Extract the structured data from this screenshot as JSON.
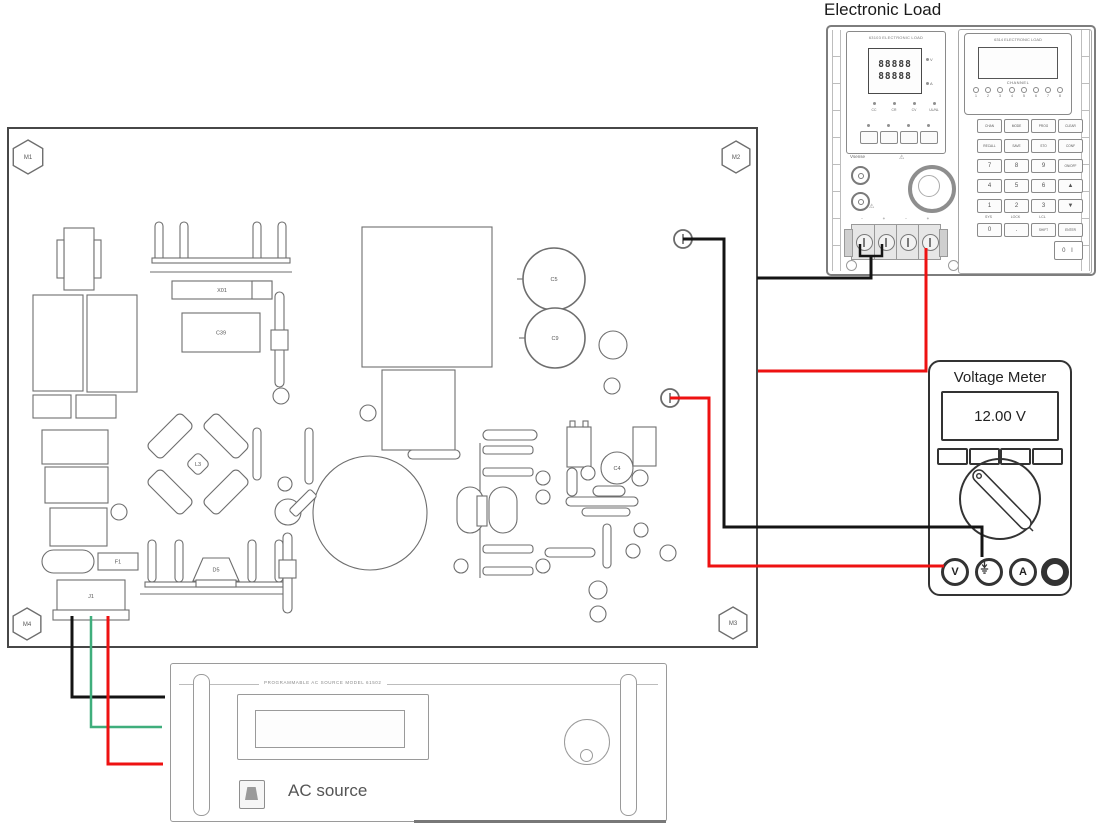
{
  "electronic_load": {
    "title": "Electronic Load",
    "left_module": {
      "model_header": "63103 ELECTRONIC LOAD",
      "display_line1": "88888",
      "display_line2": "88888",
      "unit_v": "V",
      "unit_a": "A",
      "mode_labels": [
        "CC",
        "CR",
        "CV",
        "UL/NL"
      ],
      "buttons": [
        "",
        "",
        "",
        ""
      ],
      "vsense_label": "Vsense",
      "warning_icon": "warning-triangle",
      "terminal_marks": [
        "-",
        "+",
        "-",
        "+"
      ]
    },
    "right_module": {
      "model_header": "6314 ELECTRONIC LOAD",
      "channel_label": "CHANNEL",
      "channel_numbers": [
        "1",
        "2",
        "3",
        "4",
        "5",
        "6",
        "7",
        "8"
      ],
      "keys": [
        [
          "CHAN",
          "MODE",
          "PROG",
          "CLEAR"
        ],
        [
          "RECALL",
          "SAVE",
          "STO",
          "CONF"
        ],
        [
          "7",
          "8",
          "9",
          "ON/OFF"
        ],
        [
          "4",
          "5",
          "6",
          "▲"
        ],
        [
          "1",
          "2",
          "3",
          "▼"
        ],
        [
          "0",
          ".",
          "SHIFT",
          "ENTER"
        ]
      ],
      "key_sublabels": [
        "SYS",
        "LOCK",
        "LCL"
      ],
      "power_label": "POWER",
      "power_switch_label": "0 I"
    }
  },
  "voltage_meter": {
    "title": "Voltage Meter",
    "reading": "12.00 V",
    "terminals": [
      {
        "label": "V"
      },
      {
        "icon": "ground"
      },
      {
        "label": "A"
      },
      {
        "label": ""
      }
    ]
  },
  "ac_source": {
    "panel_header": "PROGRAMMABLE AC SOURCE MODEL 61502",
    "label": "AC source",
    "keys": [
      [
        "",
        "",
        "1",
        "2",
        "3"
      ],
      [
        "",
        "",
        "4",
        "5",
        "6"
      ],
      [
        "",
        "",
        "7",
        "8",
        "9"
      ],
      [
        "",
        "",
        ".",
        "0",
        ""
      ]
    ]
  },
  "pcb": {
    "mount_labels": [
      "M1",
      "M2",
      "M3",
      "M4"
    ],
    "components": [
      {
        "t": "hex",
        "cx": 28,
        "cy": 157,
        "r": 17,
        "label": "M1"
      },
      {
        "t": "hex",
        "cx": 736,
        "cy": 157,
        "r": 16,
        "label": "M2"
      },
      {
        "t": "hex",
        "cx": 733,
        "cy": 623,
        "r": 16,
        "label": "M3"
      },
      {
        "t": "hex",
        "cx": 27,
        "cy": 624,
        "r": 16,
        "label": "M4"
      },
      {
        "t": "rect",
        "x": 64,
        "y": 228,
        "w": 30,
        "h": 62
      },
      {
        "t": "rect",
        "x": 57,
        "y": 240,
        "w": 7,
        "h": 38
      },
      {
        "t": "rect",
        "x": 94,
        "y": 240,
        "w": 7,
        "h": 38
      },
      {
        "t": "rect",
        "x": 33,
        "y": 295,
        "w": 50,
        "h": 96
      },
      {
        "t": "rect",
        "x": 87,
        "y": 295,
        "w": 50,
        "h": 97
      },
      {
        "t": "rect",
        "x": 33,
        "y": 395,
        "w": 38,
        "h": 23
      },
      {
        "t": "rect",
        "x": 76,
        "y": 395,
        "w": 40,
        "h": 23
      },
      {
        "t": "rect",
        "x": 42,
        "y": 430,
        "w": 66,
        "h": 34
      },
      {
        "t": "rect",
        "x": 45,
        "y": 467,
        "w": 63,
        "h": 36
      },
      {
        "t": "rect",
        "x": 50,
        "y": 508,
        "w": 57,
        "h": 38
      },
      {
        "t": "pill",
        "x": 42,
        "y": 550,
        "w": 52,
        "h": 23
      },
      {
        "t": "rect",
        "x": 98,
        "y": 553,
        "w": 40,
        "h": 17,
        "label": "F1"
      },
      {
        "t": "vpill",
        "x": 155,
        "y": 222,
        "w": 8,
        "h": 40
      },
      {
        "t": "vpill",
        "x": 180,
        "y": 222,
        "w": 8,
        "h": 40
      },
      {
        "t": "vpill",
        "x": 253,
        "y": 222,
        "w": 8,
        "h": 40
      },
      {
        "t": "vpill",
        "x": 278,
        "y": 222,
        "w": 8,
        "h": 40
      },
      {
        "t": "rect",
        "x": 152,
        "y": 258,
        "w": 138,
        "h": 5
      },
      {
        "t": "line",
        "x1": 150,
        "y1": 272,
        "x2": 292,
        "y2": 272
      },
      {
        "t": "rect",
        "x": 172,
        "y": 281,
        "w": 100,
        "h": 18,
        "label": "X01"
      },
      {
        "t": "rect",
        "x": 252,
        "y": 281,
        "w": 20,
        "h": 18
      },
      {
        "t": "rect",
        "x": 182,
        "y": 313,
        "w": 78,
        "h": 39,
        "label": "C39"
      },
      {
        "t": "vpill",
        "x": 275,
        "y": 292,
        "w": 9,
        "h": 95
      },
      {
        "t": "rect",
        "x": 271,
        "y": 330,
        "w": 17,
        "h": 20
      },
      {
        "t": "circle",
        "cx": 281,
        "cy": 396,
        "r": 8
      },
      {
        "t": "rect",
        "x": 362,
        "y": 227,
        "w": 130,
        "h": 140
      },
      {
        "t": "rect",
        "x": 382,
        "y": 370,
        "w": 73,
        "h": 80
      },
      {
        "t": "circle",
        "cx": 368,
        "cy": 413,
        "r": 8
      },
      {
        "t": "pill",
        "x": 408,
        "y": 450,
        "w": 52,
        "h": 9
      },
      {
        "t": "diag",
        "cx": 170,
        "cy": 436,
        "w": 48,
        "h": 20,
        "rot": -45
      },
      {
        "t": "diag",
        "cx": 226,
        "cy": 436,
        "w": 48,
        "h": 20,
        "rot": 45
      },
      {
        "t": "diag",
        "cx": 170,
        "cy": 492,
        "w": 48,
        "h": 20,
        "rot": 45
      },
      {
        "t": "diag",
        "cx": 226,
        "cy": 492,
        "w": 48,
        "h": 20,
        "rot": -45
      },
      {
        "t": "diag",
        "cx": 198,
        "cy": 464,
        "w": 17,
        "h": 17,
        "rot": 45,
        "label": "L3"
      },
      {
        "t": "circle",
        "cx": 370,
        "cy": 513,
        "r": 57
      },
      {
        "t": "circle",
        "cx": 288,
        "cy": 512,
        "r": 13
      },
      {
        "t": "circle",
        "cx": 285,
        "cy": 484,
        "r": 7
      },
      {
        "t": "diag",
        "cx": 303,
        "cy": 503,
        "w": 30,
        "h": 10,
        "rot": -45
      },
      {
        "t": "vpill",
        "x": 148,
        "y": 540,
        "w": 8,
        "h": 42
      },
      {
        "t": "vpill",
        "x": 175,
        "y": 540,
        "w": 8,
        "h": 42
      },
      {
        "t": "vpill",
        "x": 248,
        "y": 540,
        "w": 8,
        "h": 42
      },
      {
        "t": "vpill",
        "x": 275,
        "y": 540,
        "w": 8,
        "h": 42
      },
      {
        "t": "rect",
        "x": 145,
        "y": 582,
        "w": 138,
        "h": 5
      },
      {
        "t": "line",
        "x1": 140,
        "y1": 594,
        "x2": 287,
        "y2": 594
      },
      {
        "t": "trap",
        "x": 193,
        "y": 558,
        "w": 46,
        "h": 23,
        "label": "D5"
      },
      {
        "t": "rect",
        "x": 196,
        "y": 580,
        "w": 40,
        "h": 7
      },
      {
        "t": "circle",
        "cx": 119,
        "cy": 512,
        "r": 8
      },
      {
        "t": "vpill",
        "x": 253,
        "y": 428,
        "w": 8,
        "h": 52
      },
      {
        "t": "vpill",
        "x": 305,
        "y": 428,
        "w": 8,
        "h": 56
      },
      {
        "t": "vpill",
        "x": 283,
        "y": 533,
        "w": 9,
        "h": 80
      },
      {
        "t": "rect",
        "x": 279,
        "y": 560,
        "w": 17,
        "h": 18
      },
      {
        "t": "rect",
        "x": 57,
        "y": 580,
        "w": 68,
        "h": 32,
        "label": "J1"
      },
      {
        "t": "rect",
        "x": 53,
        "y": 610,
        "w": 76,
        "h": 10
      },
      {
        "t": "circle",
        "cx": 554,
        "cy": 279,
        "r": 31,
        "label": "C5",
        "sw": 1.6
      },
      {
        "t": "circle",
        "cx": 555,
        "cy": 338,
        "r": 30,
        "label": "C9",
        "sw": 1.6
      },
      {
        "t": "line",
        "x1": 517,
        "y1": 279,
        "x2": 523,
        "y2": 279
      },
      {
        "t": "line",
        "x1": 519,
        "y1": 338,
        "x2": 525,
        "y2": 338
      },
      {
        "t": "circle",
        "cx": 613,
        "cy": 345,
        "r": 14
      },
      {
        "t": "circle",
        "cx": 612,
        "cy": 386,
        "r": 8
      },
      {
        "t": "pill",
        "x": 483,
        "y": 430,
        "w": 54,
        "h": 10
      },
      {
        "t": "line",
        "x1": 480,
        "y1": 443,
        "x2": 480,
        "y2": 578
      },
      {
        "t": "rect",
        "x": 483,
        "y": 446,
        "w": 50,
        "h": 8,
        "rx": 3
      },
      {
        "t": "rect",
        "x": 483,
        "y": 468,
        "w": 50,
        "h": 8,
        "rx": 3
      },
      {
        "t": "rect",
        "x": 483,
        "y": 545,
        "w": 50,
        "h": 8,
        "rx": 3
      },
      {
        "t": "rect",
        "x": 483,
        "y": 567,
        "w": 50,
        "h": 8,
        "rx": 3
      },
      {
        "t": "vpill",
        "x": 457,
        "y": 487,
        "w": 26,
        "h": 46
      },
      {
        "t": "vpill",
        "x": 489,
        "y": 487,
        "w": 28,
        "h": 46
      },
      {
        "t": "rect",
        "x": 477,
        "y": 496,
        "w": 10,
        "h": 30
      },
      {
        "t": "circle",
        "cx": 543,
        "cy": 478,
        "r": 7
      },
      {
        "t": "circle",
        "cx": 543,
        "cy": 497,
        "r": 7
      },
      {
        "t": "circle",
        "cx": 543,
        "cy": 566,
        "r": 7
      },
      {
        "t": "circle",
        "cx": 461,
        "cy": 566,
        "r": 7
      },
      {
        "t": "pill",
        "x": 545,
        "y": 548,
        "w": 50,
        "h": 9
      },
      {
        "t": "rect",
        "x": 567,
        "y": 427,
        "w": 24,
        "h": 40
      },
      {
        "t": "rect",
        "x": 570,
        "y": 421,
        "w": 5,
        "h": 6
      },
      {
        "t": "rect",
        "x": 583,
        "y": 421,
        "w": 5,
        "h": 6
      },
      {
        "t": "vpill",
        "x": 567,
        "y": 468,
        "w": 10,
        "h": 28
      },
      {
        "t": "circle",
        "cx": 588,
        "cy": 473,
        "r": 7
      },
      {
        "t": "circle",
        "cx": 617,
        "cy": 468,
        "r": 16,
        "label": "C4"
      },
      {
        "t": "circle",
        "cx": 640,
        "cy": 478,
        "r": 8
      },
      {
        "t": "rect",
        "x": 633,
        "y": 427,
        "w": 23,
        "h": 39
      },
      {
        "t": "pill",
        "x": 593,
        "y": 486,
        "w": 32,
        "h": 10
      },
      {
        "t": "pill",
        "x": 566,
        "y": 497,
        "w": 72,
        "h": 9
      },
      {
        "t": "pill",
        "x": 582,
        "y": 508,
        "w": 48,
        "h": 8
      },
      {
        "t": "vpill",
        "x": 603,
        "y": 524,
        "w": 8,
        "h": 44
      },
      {
        "t": "circle",
        "cx": 641,
        "cy": 530,
        "r": 7
      },
      {
        "t": "circle",
        "cx": 633,
        "cy": 551,
        "r": 7
      },
      {
        "t": "circle",
        "cx": 668,
        "cy": 553,
        "r": 8
      },
      {
        "t": "circle",
        "cx": 598,
        "cy": 590,
        "r": 9
      },
      {
        "t": "circle",
        "cx": 598,
        "cy": 614,
        "r": 8
      },
      {
        "t": "term",
        "cx": 683,
        "cy": 239
      },
      {
        "t": "term",
        "cx": 670,
        "cy": 398
      }
    ]
  },
  "wires": [
    {
      "name": "wire-black-output-to-meter-com",
      "color": "#141414",
      "w": 3,
      "pts": [
        [
          683,
          239
        ],
        [
          724,
          239
        ],
        [
          724,
          527
        ],
        [
          982,
          527
        ],
        [
          982,
          557
        ]
      ]
    },
    {
      "name": "wire-red-output-to-meter-v",
      "color": "#ee1111",
      "w": 3,
      "pts": [
        [
          670,
          398
        ],
        [
          709,
          398
        ],
        [
          709,
          566
        ],
        [
          944,
          566
        ]
      ]
    },
    {
      "name": "wire-black-load-jumper",
      "color": "#141414",
      "w": 2.5,
      "pts": [
        [
          860,
          244
        ],
        [
          860,
          256
        ],
        [
          882,
          256
        ],
        [
          882,
          244
        ]
      ]
    },
    {
      "name": "wire-black-load-to-board",
      "color": "#141414",
      "w": 3,
      "pts": [
        [
          871,
          256
        ],
        [
          871,
          278
        ],
        [
          757,
          278
        ]
      ]
    },
    {
      "name": "wire-red-load-to-board",
      "color": "#ee1111",
      "w": 3,
      "pts": [
        [
          926,
          248
        ],
        [
          926,
          371
        ],
        [
          758,
          371
        ]
      ]
    },
    {
      "name": "wire-black-input-to-ac-source",
      "color": "#141414",
      "w": 3,
      "pts": [
        [
          72,
          616
        ],
        [
          72,
          697
        ],
        [
          165,
          697
        ]
      ]
    },
    {
      "name": "wire-green-input-to-ac-source",
      "color": "#3fae7c",
      "w": 2.5,
      "pts": [
        [
          91,
          616
        ],
        [
          91,
          727
        ],
        [
          162,
          727
        ]
      ]
    },
    {
      "name": "wire-red-input-to-ac-source",
      "color": "#ee1111",
      "w": 3,
      "pts": [
        [
          108,
          616
        ],
        [
          108,
          764
        ],
        [
          163,
          764
        ]
      ]
    }
  ]
}
